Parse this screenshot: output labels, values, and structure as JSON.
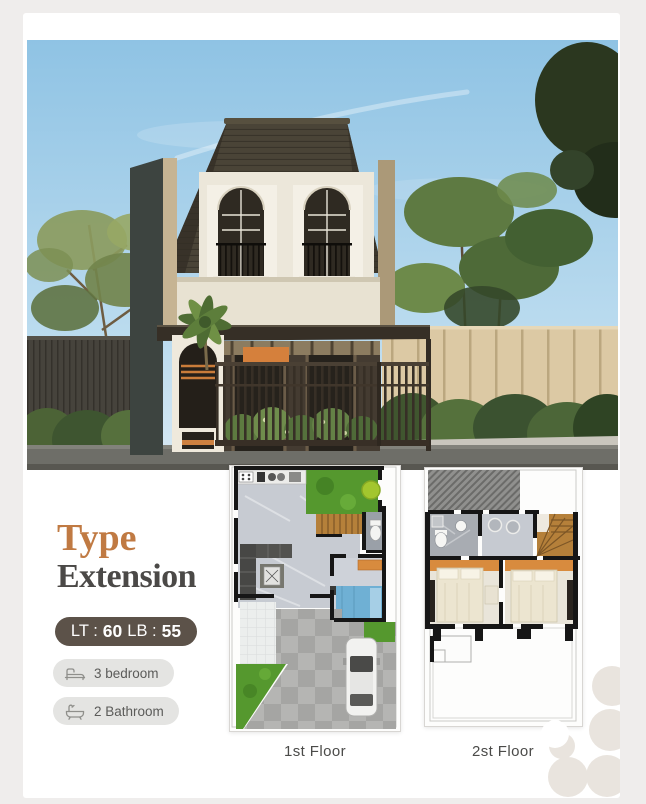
{
  "title": {
    "accent": "Type",
    "name": "Extension"
  },
  "specs": {
    "lt_label": "LT :",
    "lt_value": "60",
    "lb_label": "LB :",
    "lb_value": "55"
  },
  "badges": [
    {
      "icon": "bed-icon",
      "label": "3 bedroom"
    },
    {
      "icon": "bath-icon",
      "label": "2 Bathroom"
    }
  ],
  "floor_plans": [
    {
      "label": "1st Floor"
    },
    {
      "label": "2st Floor"
    }
  ],
  "colors": {
    "page_bg": "#efedec",
    "card_bg": "#ffffff",
    "accent_orange": "#c07a43",
    "title_dark": "#4b4947",
    "pill_bg": "#5c5249",
    "pill_text": "#ffffff",
    "badge_bg": "#e4e4e2",
    "badge_text": "#5b5b59",
    "roof_brown": "#4a4437",
    "grass_green": "#55982e",
    "stair_wood": "#b5803a",
    "accent_panel_orange": "#d5803c",
    "bed_blue": "#6fb0d4"
  }
}
